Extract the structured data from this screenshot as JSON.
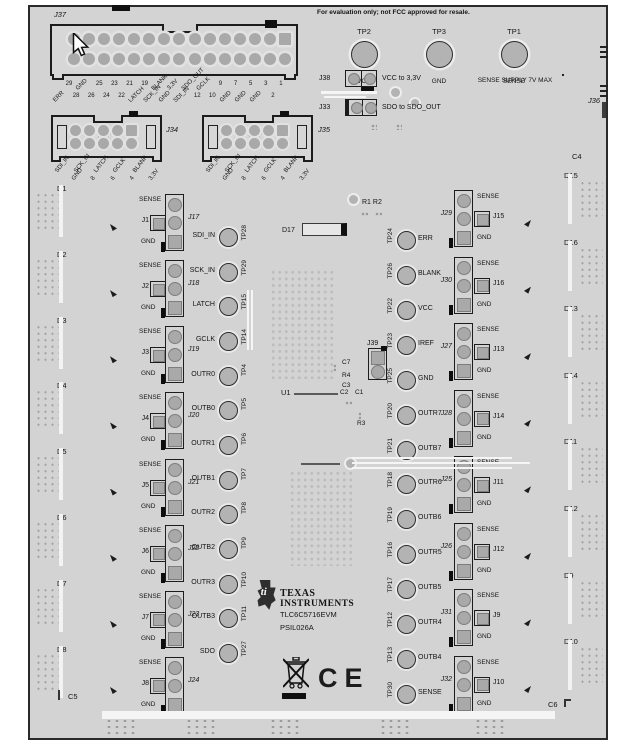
{
  "page": {
    "disclaimer": "For evaluation only; not FCC approved for resale."
  },
  "labels": {
    "sense": "SENSE",
    "gnd": "GND"
  },
  "top": {
    "j37": {
      "label": "J37",
      "row1": [
        "29",
        "GND",
        "25",
        "23",
        "21",
        "19",
        "BLANK",
        "3,3V",
        "SDO_OUT",
        "GCLK",
        "9",
        "7",
        "5",
        "3",
        "1"
      ],
      "row2": [
        "ERR",
        "28",
        "26",
        "24",
        "22",
        "LATCH",
        "SCK_IN",
        "GND",
        "SDI_IN",
        "12",
        "10",
        "GND",
        "GND",
        "GND",
        "2"
      ]
    },
    "j34": {
      "label": "J34",
      "pins": [
        "SDI_IN",
        "GND",
        "SCK_IN",
        "8",
        "LATCH",
        "6",
        "GCLK",
        "4",
        "BLANK",
        "3,3V"
      ]
    },
    "j35": {
      "label": "J35",
      "pins": [
        "SDI_IN",
        "GND",
        "SCK_IN",
        "8",
        "LATCH",
        "6",
        "GCLK",
        "4",
        "BLANK",
        "3,3V"
      ]
    },
    "test_points": [
      {
        "name": "TP2",
        "signal": "VCC"
      },
      {
        "name": "TP3",
        "signal": "GND"
      },
      {
        "name": "TP1",
        "signal": "SENSE"
      }
    ],
    "sense_note": "SENSE SUPPLY 7V MAX",
    "jumpers": [
      {
        "name": "J38",
        "function": "VCC to 3,3V"
      },
      {
        "name": "J33",
        "function": "SDO to SDO_OUT"
      }
    ],
    "j36": "J36"
  },
  "left": {
    "tp_rows": [
      {
        "signal": "SDI_IN",
        "tp": "TP28"
      },
      {
        "signal": "SCK_IN",
        "tp": "TP29"
      },
      {
        "signal": "LATCH",
        "tp": "TP15"
      },
      {
        "signal": "GCLK",
        "tp": "TP14"
      },
      {
        "signal": "OUTR0",
        "tp": "TP4"
      },
      {
        "signal": "OUTB0",
        "tp": "TP5"
      },
      {
        "signal": "OUTR1",
        "tp": "TP6"
      },
      {
        "signal": "OUTB1",
        "tp": "TP7"
      },
      {
        "signal": "OUTR2",
        "tp": "TP8"
      },
      {
        "signal": "OUTB2",
        "tp": "TP9"
      },
      {
        "signal": "OUTR3",
        "tp": "TP10"
      },
      {
        "signal": "OUTB3",
        "tp": "TP11"
      },
      {
        "signal": "SDO",
        "tp": "TP27"
      }
    ],
    "blocks": [
      {
        "jumper": "J1",
        "header": "J17"
      },
      {
        "jumper": "J2",
        "header": "J18"
      },
      {
        "jumper": "J3",
        "header": "J19"
      },
      {
        "jumper": "J4",
        "header": "J20"
      },
      {
        "jumper": "J5",
        "header": "J21"
      },
      {
        "jumper": "J6",
        "header": "J22"
      },
      {
        "jumper": "J7",
        "header": "J23"
      },
      {
        "jumper": "J8",
        "header": "J24"
      }
    ],
    "diodes": [
      "D1",
      "D2",
      "D3",
      "D4",
      "D5",
      "D6",
      "D7",
      "D8"
    ],
    "c5": "C5"
  },
  "center": {
    "tp_rows": [
      {
        "tp": "TP24",
        "signal": "ERR"
      },
      {
        "tp": "TP26",
        "signal": "BLANK"
      },
      {
        "tp": "TP22",
        "signal": "VCC"
      },
      {
        "tp": "TP23",
        "signal": "IREF"
      },
      {
        "tp": "TP25",
        "signal": "GND"
      },
      {
        "tp": "TP20",
        "signal": "OUTR7"
      },
      {
        "tp": "TP21",
        "signal": "OUTB7"
      },
      {
        "tp": "TP18",
        "signal": "OUTR6"
      },
      {
        "tp": "TP19",
        "signal": "OUTB6"
      },
      {
        "tp": "TP16",
        "signal": "OUTR5"
      },
      {
        "tp": "TP17",
        "signal": "OUTB5"
      },
      {
        "tp": "TP12",
        "signal": "OUTR4"
      },
      {
        "tp": "TP13",
        "signal": "OUTB4"
      },
      {
        "tp": "TP30",
        "signal": "SENSE"
      }
    ],
    "refs": {
      "r1r2": "R1 R2",
      "d17": "D17",
      "u1": "U1",
      "j39": "J39",
      "c7": "C7",
      "r4": "R4",
      "c3": "C3",
      "c2": "C2",
      "c1": "C1",
      "r3": "R3"
    }
  },
  "right": {
    "blocks": [
      {
        "header": "J29",
        "jumper": "J15"
      },
      {
        "header": "J30",
        "jumper": "J16"
      },
      {
        "header": "J27",
        "jumper": "J13"
      },
      {
        "header": "J28",
        "jumper": "J14"
      },
      {
        "header": "J25",
        "jumper": "J11"
      },
      {
        "header": "J26",
        "jumper": "J12"
      },
      {
        "header": "J31",
        "jumper": "J9"
      },
      {
        "header": "J32",
        "jumper": "J10"
      }
    ],
    "diodes": [
      "D15",
      "D16",
      "D13",
      "D14",
      "D11",
      "D12",
      "D9",
      "D10"
    ],
    "c4": "C4",
    "c6": "C6"
  },
  "branding": {
    "company_top": "TEXAS",
    "company_bottom": "INSTRUMENTS",
    "part_number": "TLC6C5716EVM",
    "assembly_number": "PSIL026A",
    "ce_mark": "CE"
  }
}
